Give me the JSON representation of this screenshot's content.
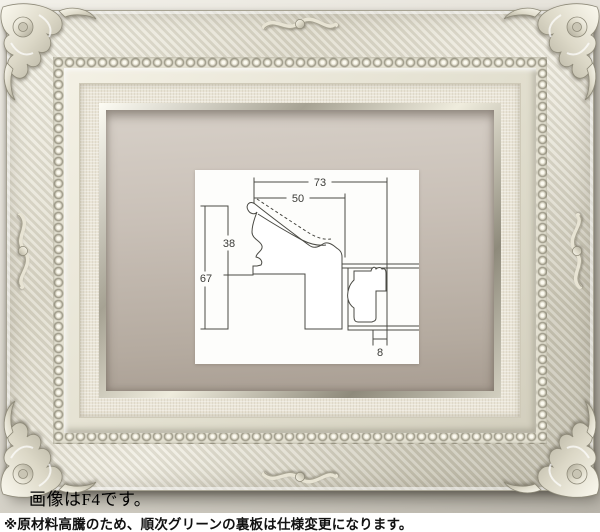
{
  "photo": {
    "caption": "画像はF4です。"
  },
  "notice": {
    "text": "※原材料高騰のため、順次グリーンの裏板は仕様変更になります。"
  },
  "diagram": {
    "subject": "frame-moulding-cross-section",
    "dims": {
      "total_width": "73",
      "face_width": "50",
      "face_height": "38",
      "total_height": "67",
      "lip_width": "8"
    }
  },
  "colors": {
    "frame_silver": "#e9e6d7",
    "frame_shade": "#a5a192",
    "liner_linen": "#eae5d7",
    "backing_taupe": "#bfb5ab",
    "wall": "#ddd9d0",
    "diagram_bg": "#fdfdfb",
    "diagram_line": "#4a4a44",
    "notice_bg": "#ffffff",
    "notice_text": "#111111"
  }
}
